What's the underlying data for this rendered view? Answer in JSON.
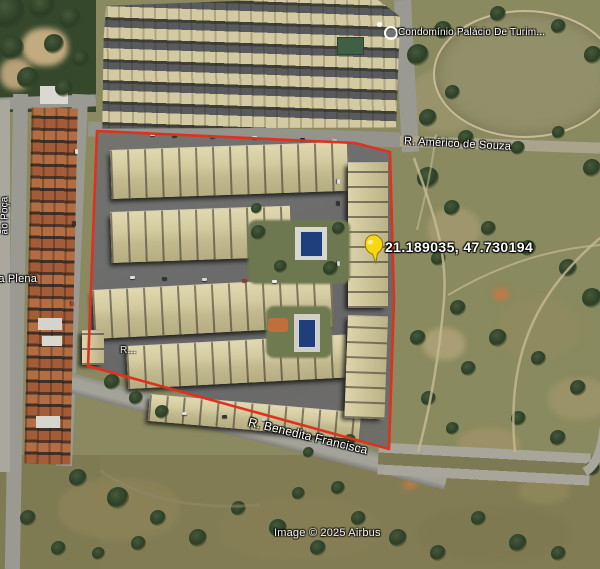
{
  "labels": {
    "poi": "Condomínio Palácio De Turim...",
    "street_top": "R. Américo de Souza",
    "street_bottom": "R. Benedita Francisca",
    "street_left_partial": "da Plena",
    "street_left_vertical": "ão Poça",
    "street_inner_partial": "R...",
    "pin_coords": "21.189035, 47.730194",
    "copyright": "Image © 2025 Airbus"
  },
  "colors": {
    "boundary_red": "#e0301e",
    "pushpin_yellow": "#f6d711",
    "pool_blue": "#1e3f7c",
    "label_text": "#ffffff"
  }
}
